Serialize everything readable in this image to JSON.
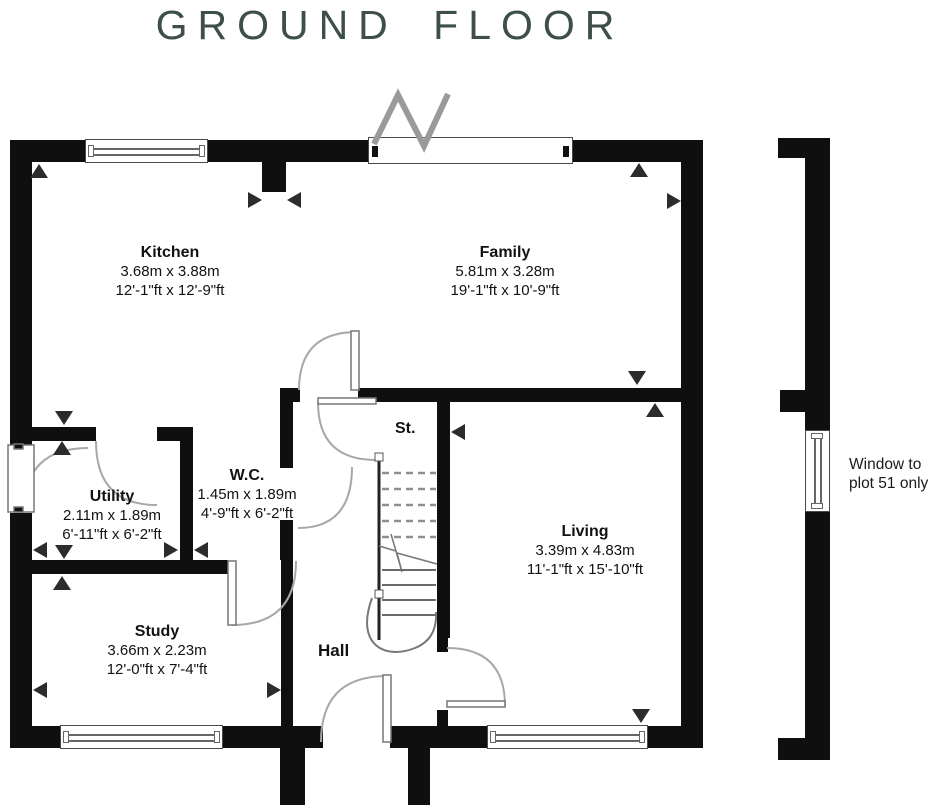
{
  "title": "GROUND FLOOR",
  "rooms": {
    "kitchen": {
      "name": "Kitchen",
      "metric": "3.68m x 3.88m",
      "imperial": "12'-1\"ft x 12'-9\"ft"
    },
    "family": {
      "name": "Family",
      "metric": "5.81m x 3.28m",
      "imperial": "19'-1\"ft x 10'-9\"ft"
    },
    "utility": {
      "name": "Utility",
      "metric": "2.11m x 1.89m",
      "imperial": "6'-11\"ft x 6'-2\"ft"
    },
    "wc": {
      "name": "W.C.",
      "metric": "1.45m x 1.89m",
      "imperial": "4'-9\"ft x 6'-2\"ft"
    },
    "study": {
      "name": "Study",
      "metric": "3.66m x 2.23m",
      "imperial": "12'-0\"ft x 7'-4\"ft"
    },
    "living": {
      "name": "Living",
      "metric": "3.39m x 4.83m",
      "imperial": "11'-1\"ft x 15'-10\"ft"
    }
  },
  "labels": {
    "hall": "Hall",
    "stairs": "St."
  },
  "annotation": {
    "line1": "Window to",
    "line2": "plot 51 only"
  },
  "colors": {
    "wall": "#0f0f0f",
    "title": "#3e4e49",
    "marker": "#2c2c2c",
    "door_arc": "#a8a8a8",
    "stair_line": "#777777"
  }
}
